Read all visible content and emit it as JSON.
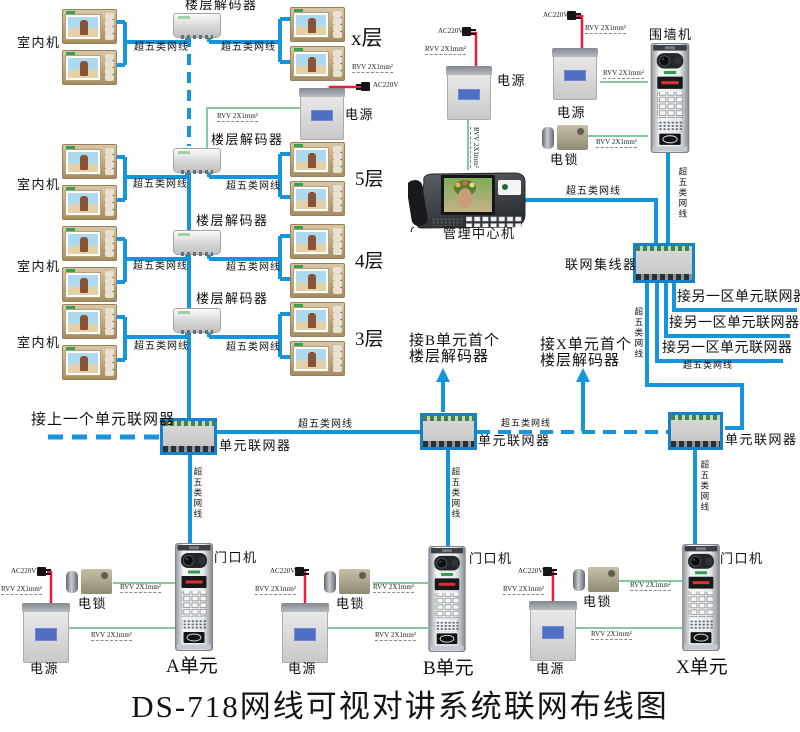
{
  "title": "DS-718网线可视对讲系统联网布线图",
  "labels": {
    "indoor_unit": "室内机",
    "floor_decoder": "楼层解码器",
    "cat5": "超五类网线",
    "rvv": "RVV 2X1mm²",
    "ac220v": "AC220V",
    "power": "电源",
    "lock": "电锁",
    "perimeter_unit": "围墙机",
    "management_center": "管理中心机",
    "network_hub": "联网集线器",
    "unit_networker": "单元联网器",
    "door_unit": "门口机",
    "to_prev_unit": "接上一个单元联网器",
    "to_other_zone": "接另一区单元联网器",
    "to_b_line1": "接B单元首个",
    "to_x_line1": "接X单元首个"
  },
  "floors": [
    "x层",
    "5层",
    "4层",
    "3层"
  ],
  "units": [
    "A单元",
    "B单元",
    "X单元"
  ],
  "colors": {
    "wire_cat5_blue": "#1496dc",
    "wire_rvv_green": "#85c9a0",
    "wire_ac_red": "#ea1c3f"
  }
}
